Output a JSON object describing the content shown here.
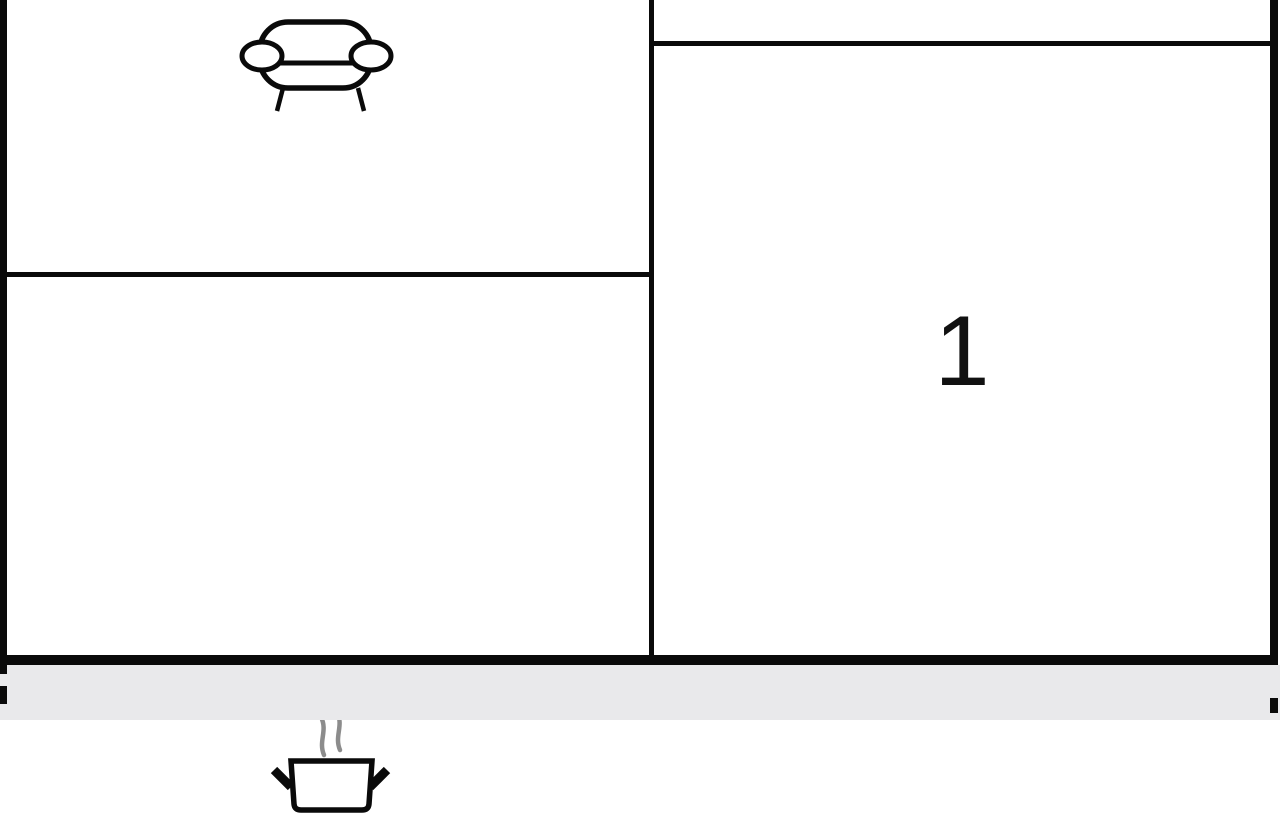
{
  "floorplan": {
    "room_label": "1",
    "icons": [
      {
        "name": "sofa-icon"
      },
      {
        "name": "steaming-pot-icon"
      }
    ],
    "colors": {
      "wall": "#0a0a0a",
      "icon_stroke": "#0a0a0a",
      "steam": "#8c8c8c",
      "margin_bar": "#e9e9eb",
      "background": "#ffffff",
      "label": "#111111"
    }
  }
}
